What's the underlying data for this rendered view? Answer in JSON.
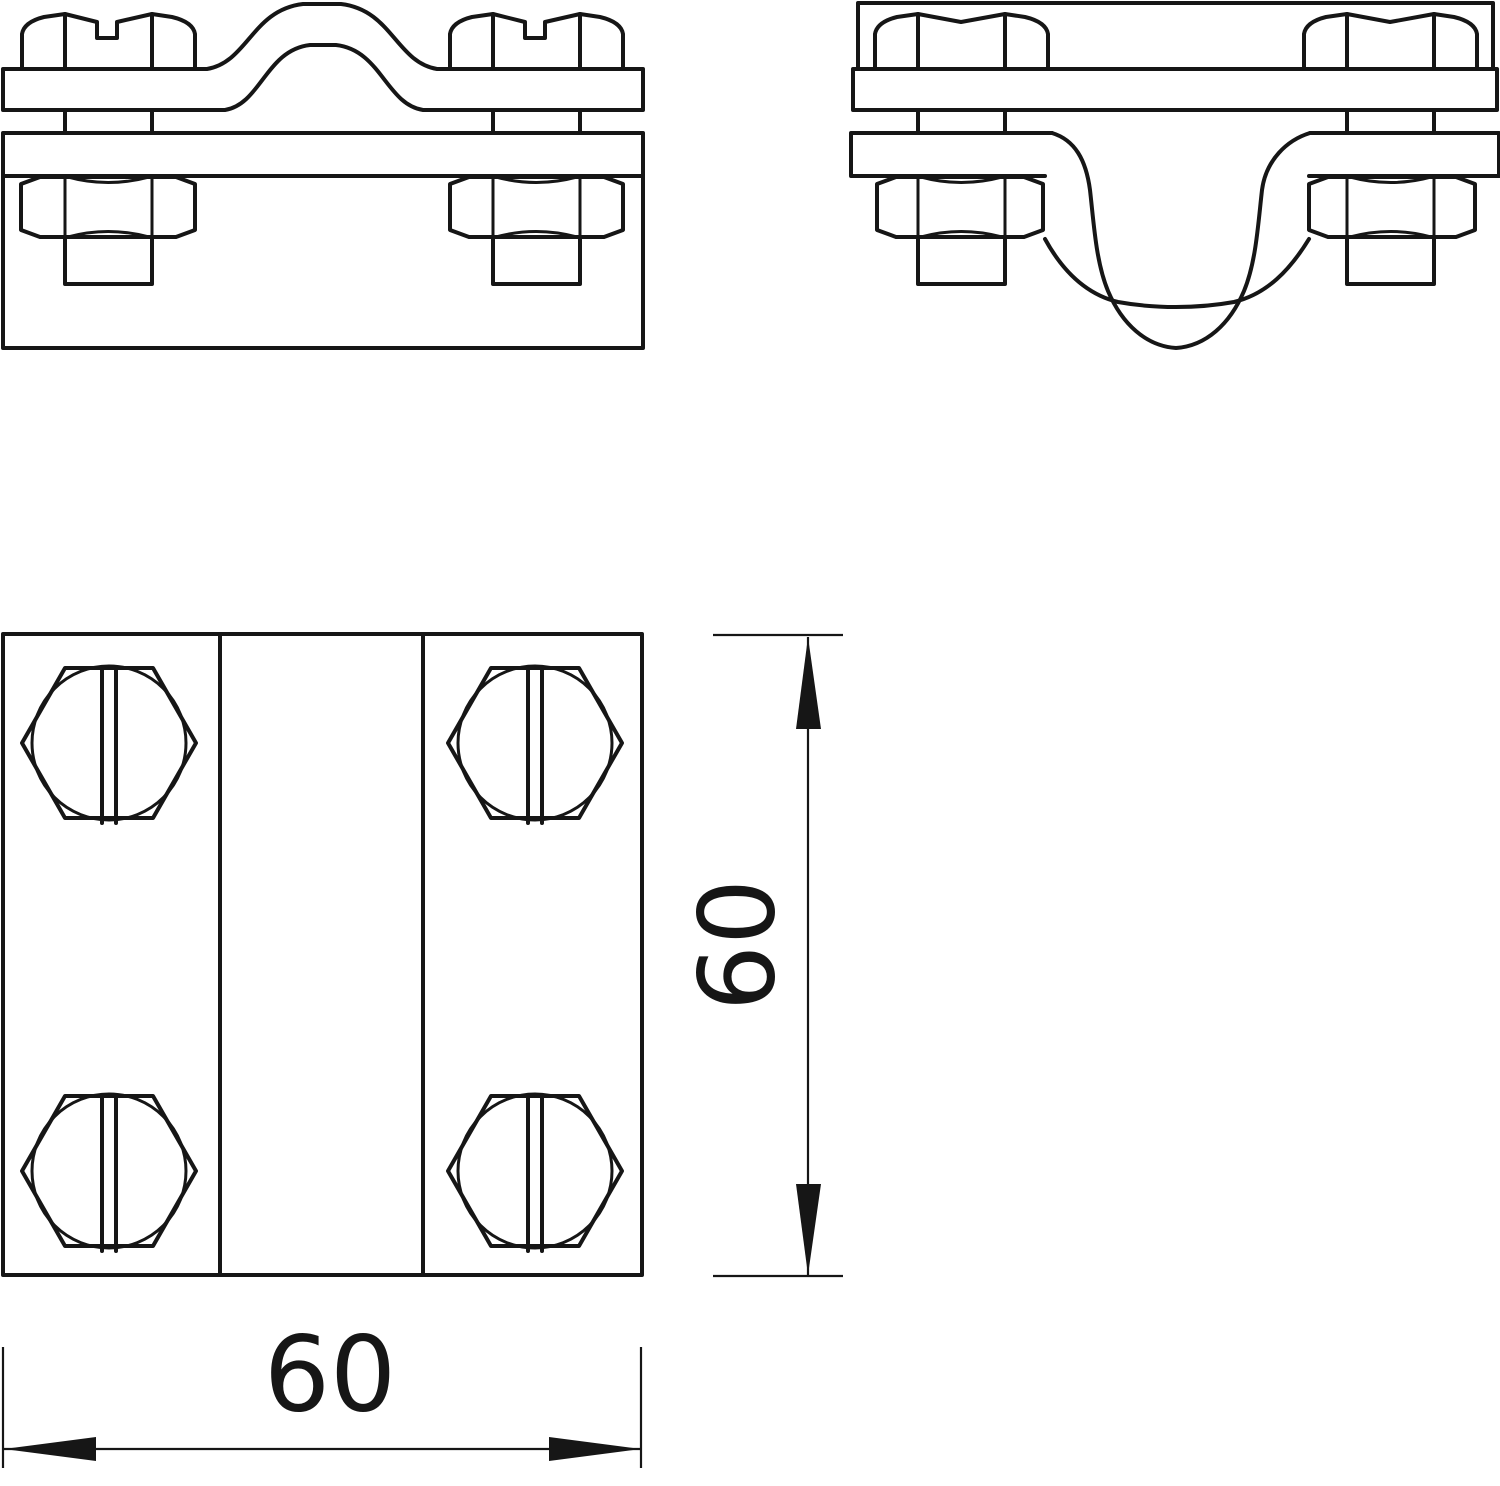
{
  "drawing": {
    "background_color": "#ffffff",
    "line_color": "#161616",
    "dimensions": {
      "width": {
        "label": "60"
      },
      "height": {
        "label": "60"
      }
    }
  }
}
